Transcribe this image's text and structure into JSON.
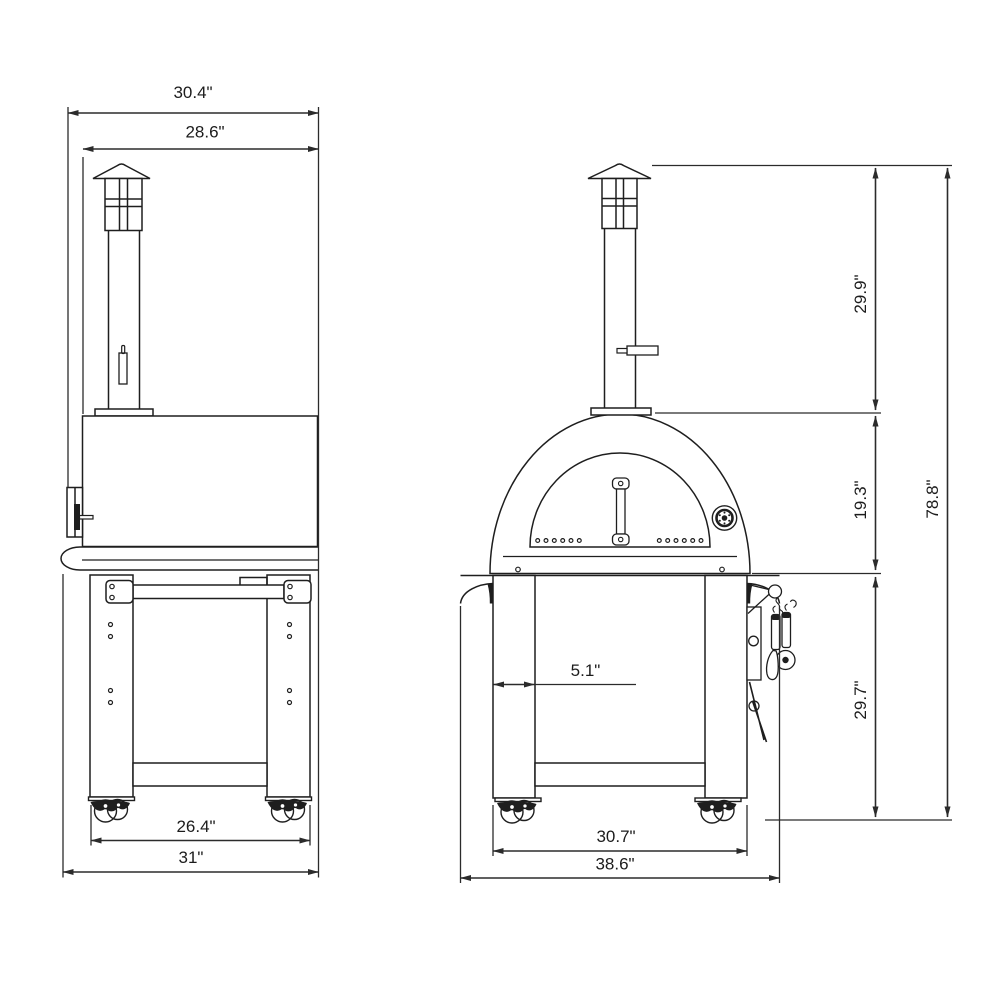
{
  "drawing": {
    "kind": "technical dimension diagram",
    "subject": "outdoor pizza oven with chimney and rolling stand, side and front elevations"
  },
  "side_view": {
    "overall_depth": "30.4\"",
    "body_depth": "28.6\"",
    "caster_span": "26.4\"",
    "base_depth": "31\""
  },
  "front_view": {
    "chimney_height": "29.9\"",
    "oven_height": "19.3\"",
    "overall_height": "78.8\"",
    "stand_height": "29.7\"",
    "leg_width": "5.1\"",
    "leg_span": "30.7\"",
    "overall_width": "38.6\""
  },
  "colors": {
    "line": "#1e1e1e",
    "dimension": "#2b2b2b",
    "background": "#ffffff"
  }
}
